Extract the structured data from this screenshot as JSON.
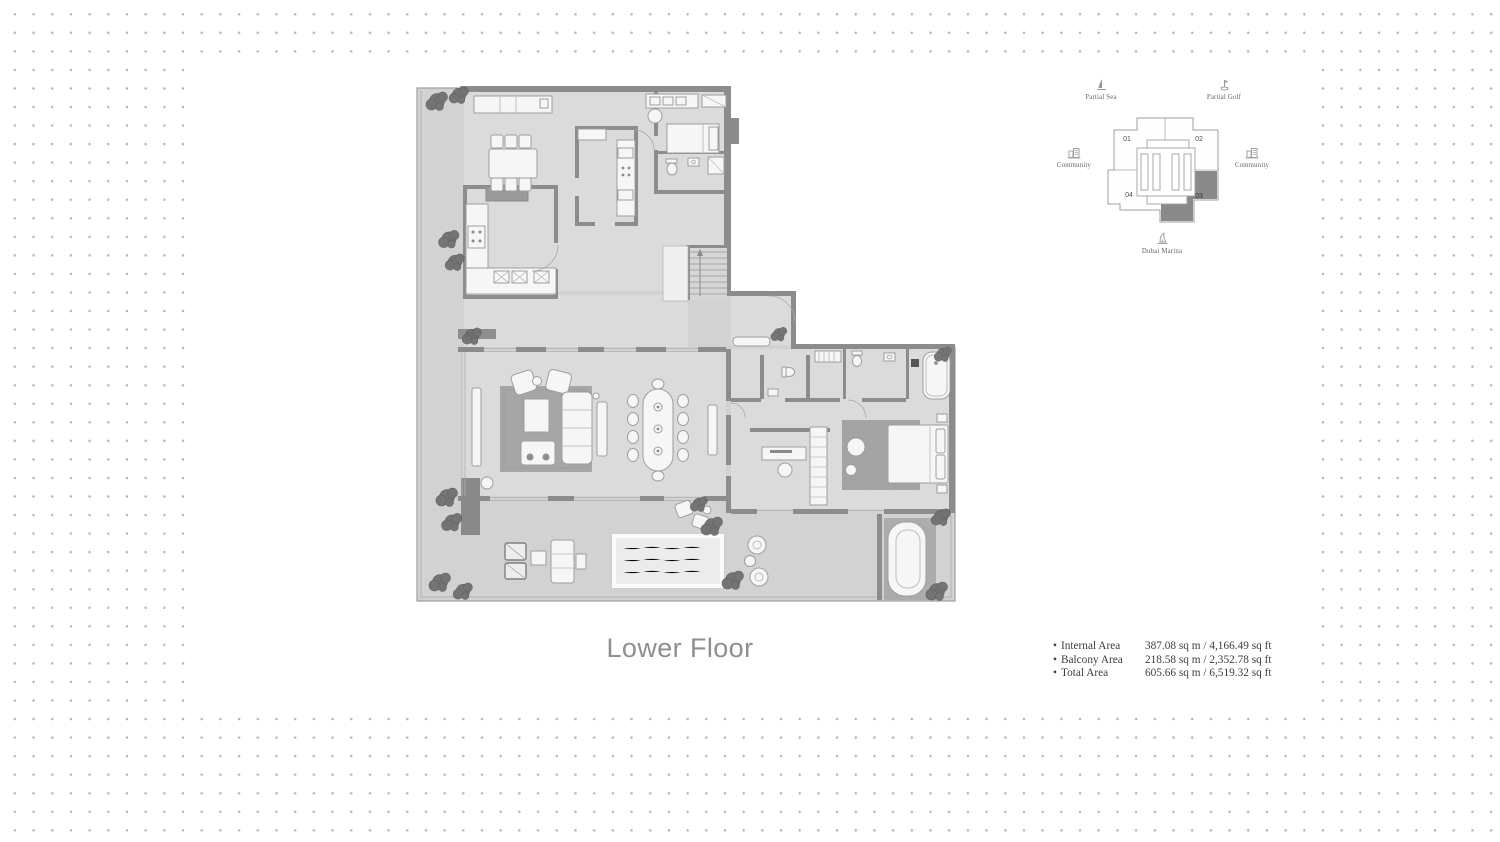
{
  "page": {
    "background_dot_color": "#b7b7b7",
    "panel_background": "#ffffff"
  },
  "title": {
    "label": "Lower Floor"
  },
  "key_plan": {
    "highlight_color": "#8a8a8a",
    "outline_color": "#9f9f9f",
    "landmarks": [
      {
        "id": "partial-sea",
        "label": "Partial Sea",
        "icon": "sail-icon"
      },
      {
        "id": "partial-golf",
        "label": "Partial Golf",
        "icon": "golf-flag-icon"
      },
      {
        "id": "community-west",
        "label": "Community",
        "icon": "buildings-icon"
      },
      {
        "id": "community-east",
        "label": "Community",
        "icon": "buildings-icon"
      },
      {
        "id": "dubai-marina",
        "label": "Dubai Marina",
        "icon": "marina-sail-icon"
      }
    ],
    "units": [
      {
        "number": "01",
        "highlighted": false
      },
      {
        "number": "02",
        "highlighted": false
      },
      {
        "number": "04",
        "highlighted": false
      },
      {
        "number": "03",
        "highlighted": true
      }
    ]
  },
  "areas": {
    "bullet": "•",
    "rows": [
      {
        "label": "Internal Area",
        "value": "387.08 sq m / 4,166.49 sq ft"
      },
      {
        "label": "Balcony Area",
        "value": "218.58 sq m / 2,352.78 sq ft"
      },
      {
        "label": "Total Area",
        "value": "605.66 sq m / 6,519.32 sq ft"
      }
    ]
  },
  "floor_plan": {
    "description": "Lower floor apartment plan drawing",
    "wall_color": "#8c8c8c",
    "floor_color": "#d2d2d2"
  }
}
